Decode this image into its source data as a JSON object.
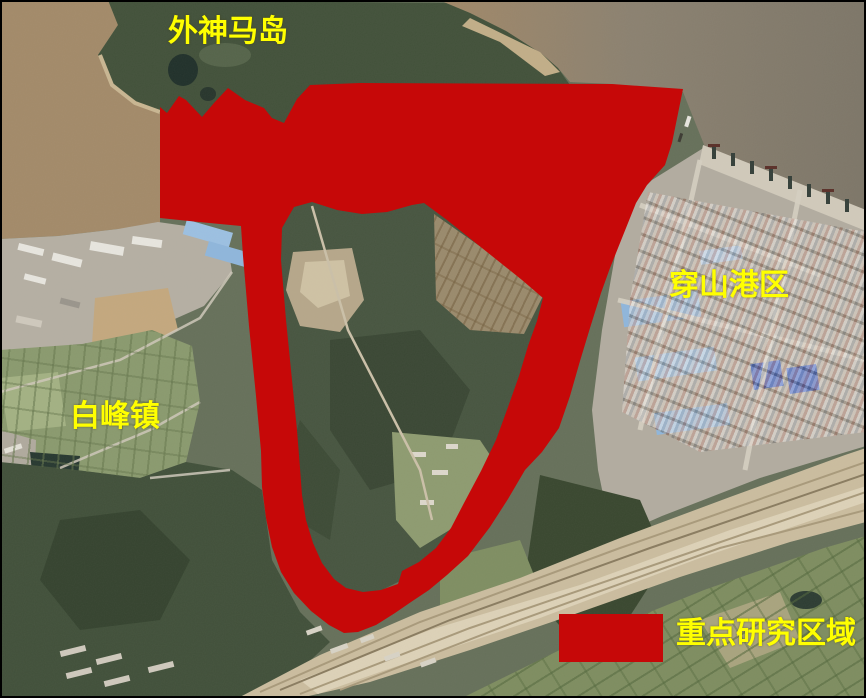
{
  "colors": {
    "overlay_red": "#C60808",
    "legend_swatch": "#C60808",
    "label_yellow": "#FFFF00"
  },
  "labels": {
    "island": "外神马岛",
    "port": "穿山港区",
    "town": "白峰镇"
  },
  "legend": {
    "label": "重点研究区域"
  }
}
